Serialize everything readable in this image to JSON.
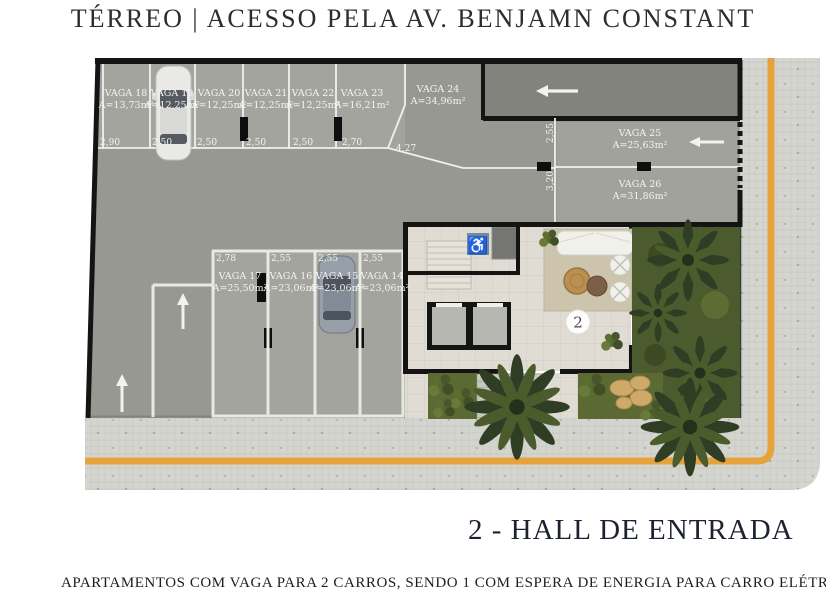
{
  "title": "TÉRREO | ACESSO PELA AV. BENJAMN CONSTANT",
  "legend": {
    "hall_marker": "2",
    "hall_label": "2 - HALL DE ENTRADA"
  },
  "note": {
    "text": "APARTAMENTOS COM VAGA PARA 2 CARROS, SENDO 1 COM ESPERA DE ENERGIA PARA CARRO ELÉTRICO."
  },
  "icons": {
    "wheelchair": "♿"
  },
  "vagas": [
    {
      "name": "VAGA 18",
      "area": "A=13,73m²",
      "dim": "2,90"
    },
    {
      "name": "VAGA 19",
      "area": "A=12,25m²",
      "dim": "2,50"
    },
    {
      "name": "VAGA 20",
      "area": "A=12,25m²",
      "dim": "2,50"
    },
    {
      "name": "VAGA 21",
      "area": "A=12,25m²",
      "dim": "2,50"
    },
    {
      "name": "VAGA 22",
      "area": "A=12,25m²",
      "dim": "2,50"
    },
    {
      "name": "VAGA 23",
      "area": "A=16,21m²",
      "dim": "2,70"
    },
    {
      "name": "VAGA 24",
      "area": "A=34,96m²",
      "dim": "4,27"
    },
    {
      "name": "VAGA 25",
      "area": "A=25,63m²",
      "dim": "2,55"
    },
    {
      "name": "VAGA 26",
      "area": "A=31,86m²",
      "dim": "3,20"
    },
    {
      "name": "VAGA 17",
      "area": "A=25,50m²",
      "dim": "2,78"
    },
    {
      "name": "VAGA 16",
      "area": "A=23,06m²",
      "dim": "2,55"
    },
    {
      "name": "VAGA 15",
      "area": "A=23,06m²",
      "dim": "2,55"
    },
    {
      "name": "VAGA 14",
      "area": "A=23,06m²",
      "dim": "2,55"
    }
  ],
  "colors": {
    "boundary_line": "#e6a23c",
    "wall": "#141414",
    "concrete": "#989893",
    "sidewalk": "#d5d5d0",
    "garden": "#4c5b2d",
    "accessible_blue": "#74889f"
  }
}
